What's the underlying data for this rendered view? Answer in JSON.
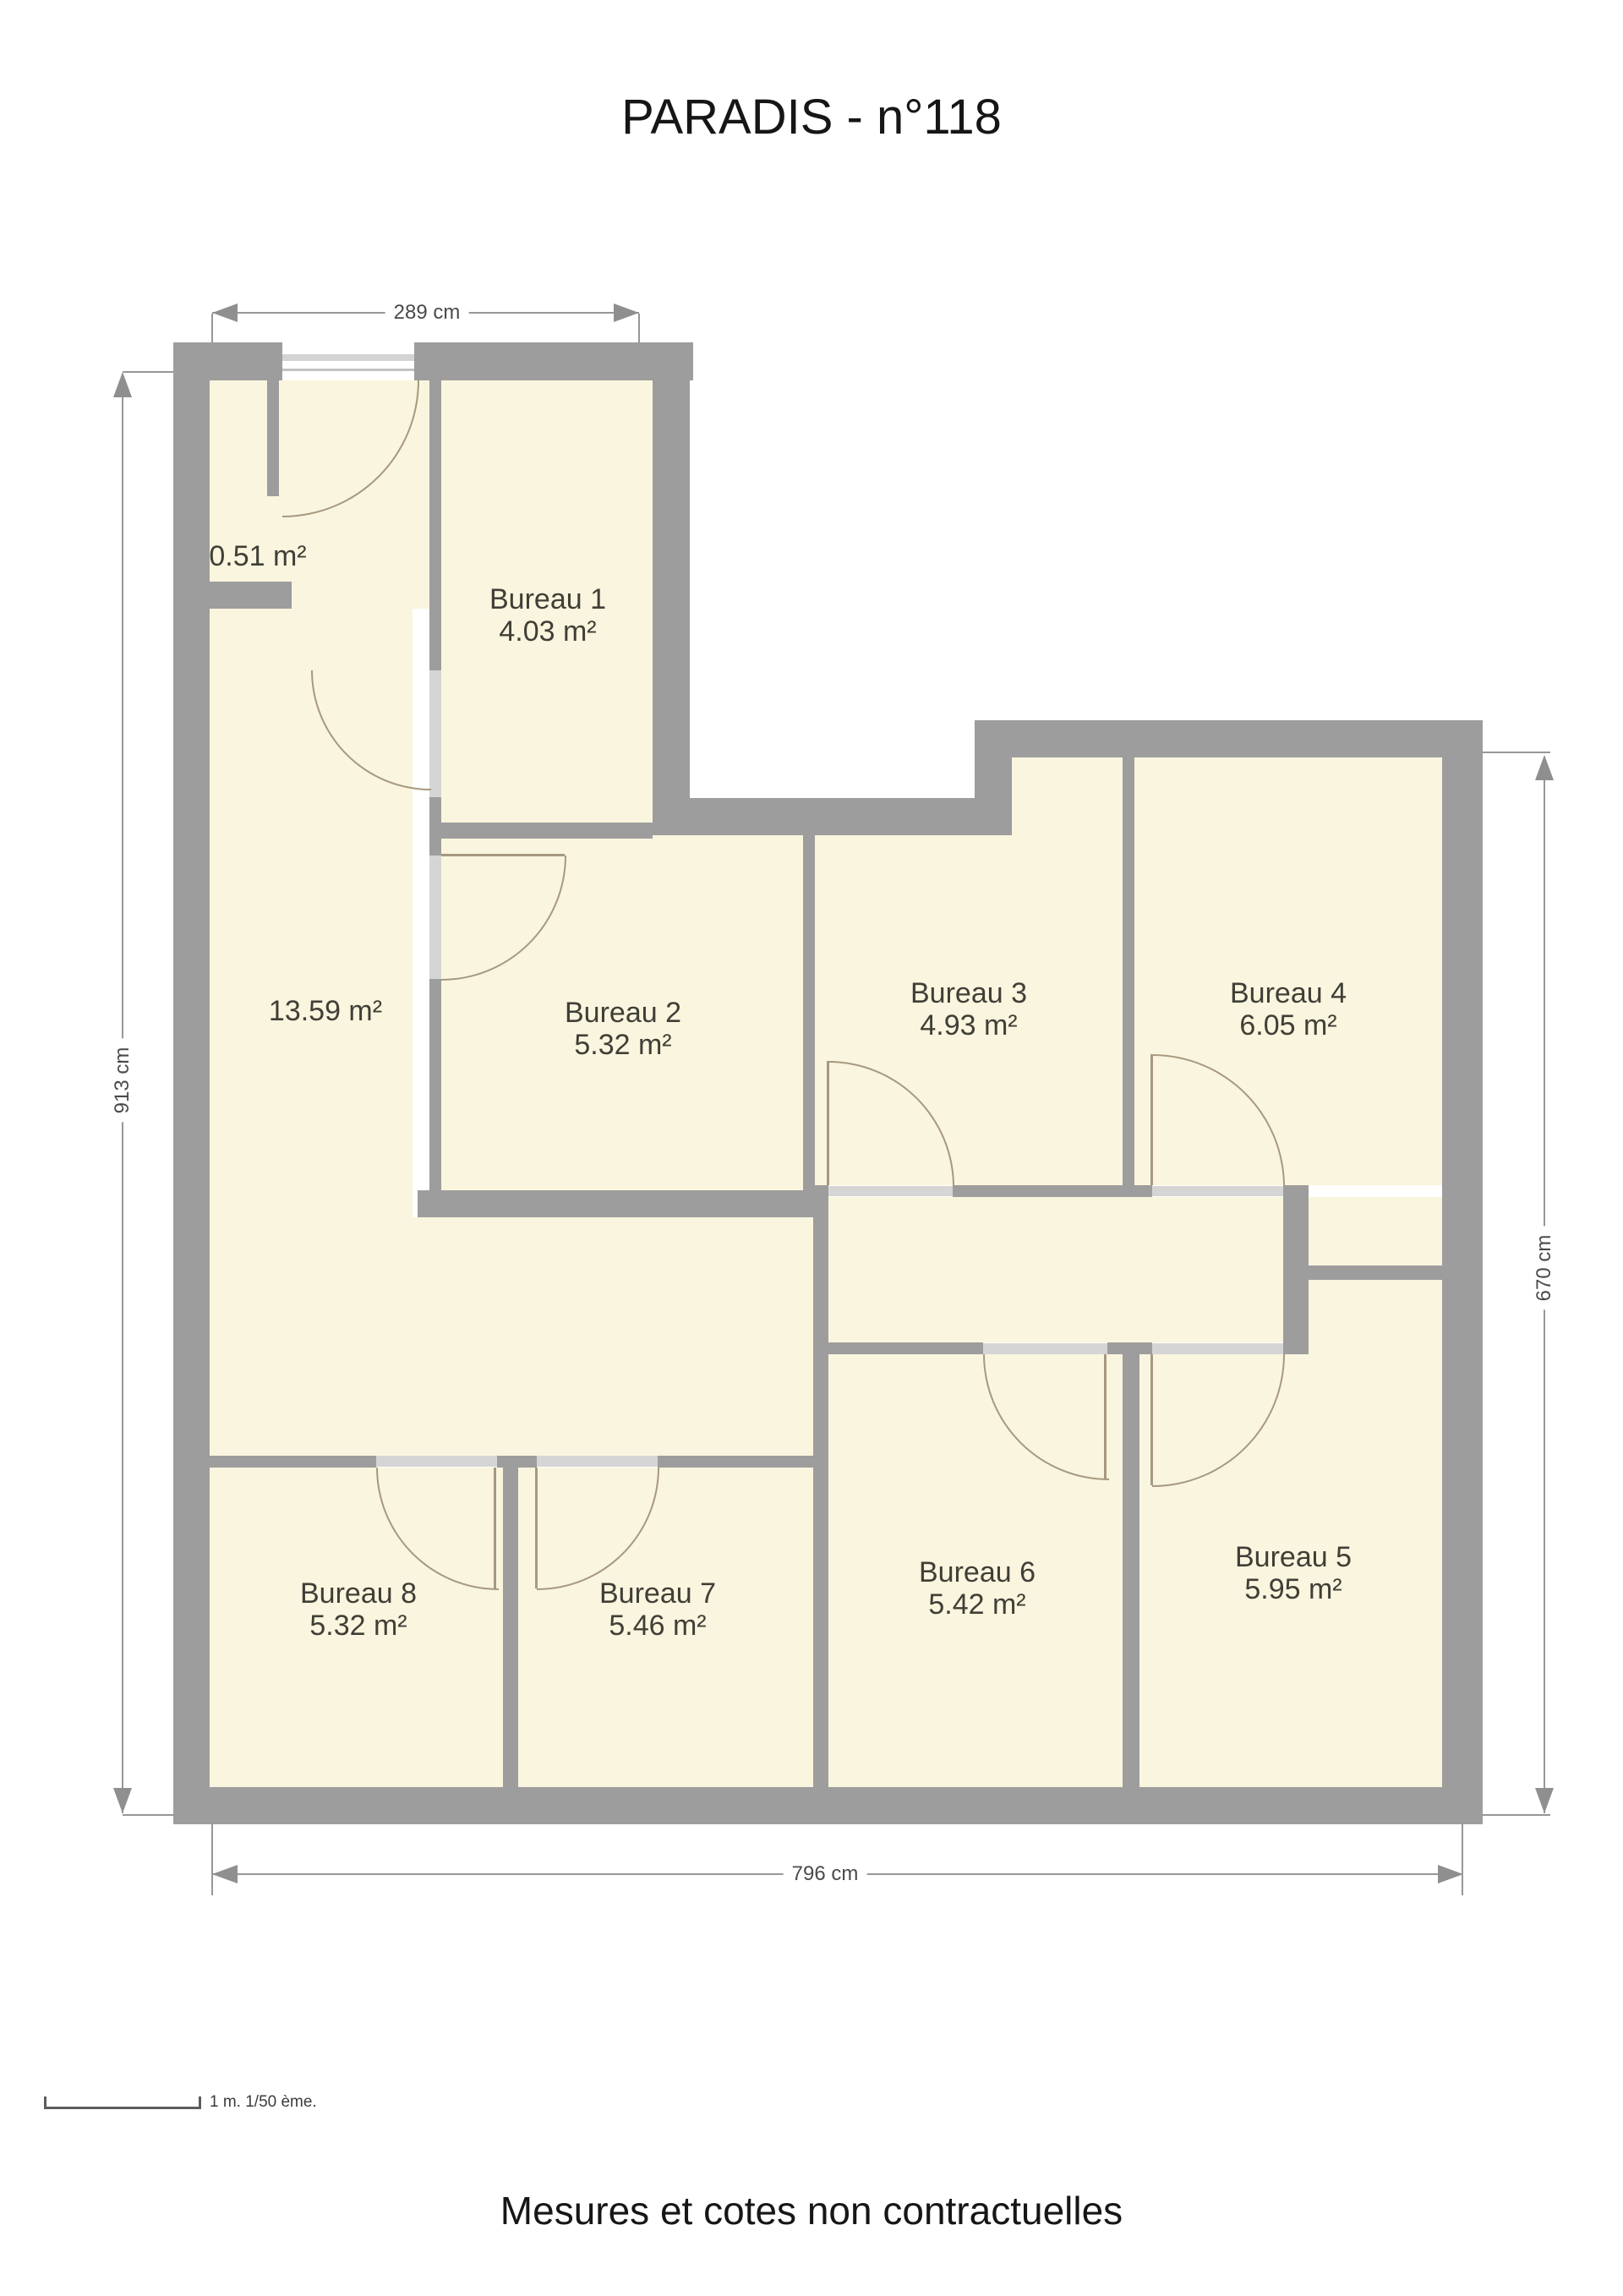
{
  "title": "PARADIS - n°118",
  "footer": "Mesures et cotes non contractuelles",
  "scale_note": "1 m. 1/50 ème.",
  "dimensions": {
    "top": "289 cm",
    "left": "913 cm",
    "right": "670 cm",
    "bottom": "796 cm"
  },
  "rooms": {
    "closet": {
      "area": "0.51 m²"
    },
    "hall": {
      "area": "13.59 m²"
    },
    "b1": {
      "name": "Bureau 1",
      "area": "4.03 m²"
    },
    "b2": {
      "name": "Bureau 2",
      "area": "5.32 m²"
    },
    "b3": {
      "name": "Bureau 3",
      "area": "4.93 m²"
    },
    "b4": {
      "name": "Bureau 4",
      "area": "6.05 m²"
    },
    "b5": {
      "name": "Bureau 5",
      "area": "5.95 m²"
    },
    "b6": {
      "name": "Bureau 6",
      "area": "5.42 m²"
    },
    "b7": {
      "name": "Bureau 7",
      "area": "5.46 m²"
    },
    "b8": {
      "name": "Bureau 8",
      "area": "5.32 m²"
    }
  },
  "colors": {
    "wall": "#9d9d9d",
    "floor": "#faf5de",
    "door_sill": "#d5d5d5",
    "door_arc": "#a6997f",
    "dimension_line": "#8f8f8f",
    "label_text": "#3f3f37"
  }
}
